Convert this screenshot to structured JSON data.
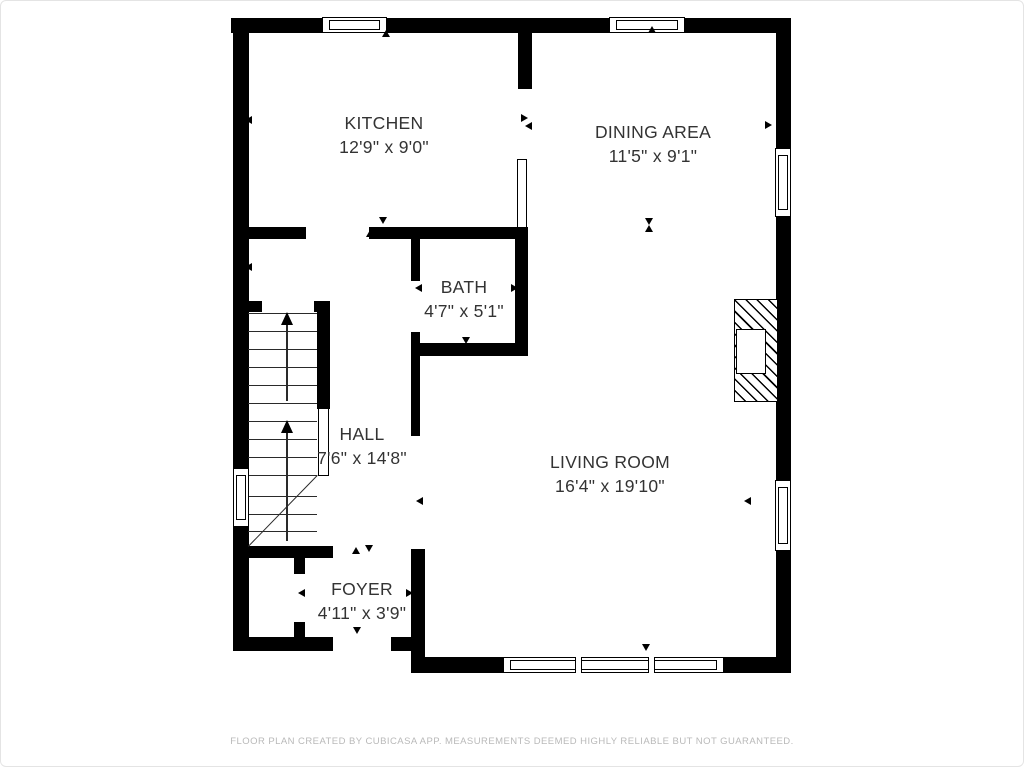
{
  "rooms": [
    {
      "name": "kitchen",
      "label": "KITCHEN",
      "dims": "12'9\" x 9'0\"",
      "cx": 383,
      "top": 110
    },
    {
      "name": "dining-area",
      "label": "DINING AREA",
      "dims": "11'5\" x 9'1\"",
      "cx": 652,
      "top": 119
    },
    {
      "name": "bath",
      "label": "BATH",
      "dims": "4'7\" x 5'1\"",
      "cx": 463,
      "top": 274
    },
    {
      "name": "hall",
      "label": "HALL",
      "dims": "7'6\" x 14'8\"",
      "cx": 361,
      "top": 421
    },
    {
      "name": "living-room",
      "label": "LIVING ROOM",
      "dims": "16'4\" x 19'10\"",
      "cx": 609,
      "top": 449
    },
    {
      "name": "foyer",
      "label": "FOYER",
      "dims": "4'11\" x 3'9\"",
      "cx": 361,
      "top": 576
    }
  ],
  "footer": {
    "text": "FLOOR PLAN CREATED BY CUBICASA APP. MEASUREMENTS DEEMED HIGHLY RELIABLE BUT NOT GUARANTEED."
  },
  "colors": {
    "wall": "#000000",
    "stair_line": "#2a2a2a",
    "room_text": "#333333",
    "footer_text": "#b9b9b9"
  },
  "plan_geometry": {
    "walls": [
      {
        "id": "exterior-top",
        "r": [
          230,
          17,
          560,
          15
        ]
      },
      {
        "id": "exterior-left",
        "r": [
          232,
          17,
          16,
          633
        ]
      },
      {
        "id": "foyer-bottom-left",
        "r": [
          232,
          636,
          100,
          14
        ]
      },
      {
        "id": "foyer-bottom-right",
        "r": [
          390,
          636,
          34,
          14
        ]
      },
      {
        "id": "living-left",
        "r": [
          410,
          548,
          14,
          124
        ]
      },
      {
        "id": "exterior-bottom",
        "r": [
          410,
          656,
          380,
          16
        ]
      },
      {
        "id": "exterior-right",
        "r": [
          775,
          17,
          15,
          655
        ]
      },
      {
        "id": "kitchen-dining-stub",
        "r": [
          517,
          30,
          14,
          58
        ]
      },
      {
        "id": "hall-top",
        "r": [
          245,
          226,
          60,
          12
        ]
      },
      {
        "id": "bath-top",
        "r": [
          368,
          226,
          159,
          12
        ]
      },
      {
        "id": "bath-left-upper",
        "r": [
          410,
          238,
          9,
          42
        ]
      },
      {
        "id": "bath-left-lower",
        "r": [
          410,
          331,
          9,
          23
        ]
      },
      {
        "id": "bath-bottom",
        "r": [
          410,
          342,
          117,
          13
        ]
      },
      {
        "id": "bath-right",
        "r": [
          514,
          226,
          13,
          129
        ]
      },
      {
        "id": "hall-right",
        "r": [
          410,
          354,
          9,
          81
        ]
      },
      {
        "id": "stair-stub-left",
        "r": [
          247,
          300,
          14,
          11
        ]
      },
      {
        "id": "stair-stub-right",
        "r": [
          313,
          300,
          15,
          11
        ]
      },
      {
        "id": "stair-right",
        "r": [
          316,
          300,
          13,
          108
        ]
      },
      {
        "id": "stair-bottom",
        "r": [
          247,
          545,
          85,
          12
        ]
      },
      {
        "id": "closet-right-upper",
        "r": [
          293,
          557,
          11,
          16
        ]
      },
      {
        "id": "closet-right-lower",
        "r": [
          293,
          621,
          11,
          16
        ]
      }
    ],
    "windows": [
      {
        "id": "kitchen-top",
        "orient": "h",
        "r": [
          321,
          16,
          65,
          16
        ]
      },
      {
        "id": "dining-top",
        "orient": "h",
        "r": [
          608,
          16,
          76,
          16
        ]
      },
      {
        "id": "dining-right",
        "orient": "v",
        "r": [
          774,
          147,
          16,
          69
        ]
      },
      {
        "id": "living-right",
        "orient": "v",
        "r": [
          774,
          479,
          16,
          71
        ]
      },
      {
        "id": "hall-left",
        "orient": "v",
        "r": [
          232,
          467,
          16,
          59
        ]
      },
      {
        "id": "living-bottom",
        "orient": "h",
        "r": [
          502,
          656,
          221,
          16
        ],
        "dividers": [
          71,
          144
        ]
      }
    ],
    "doors": [
      {
        "id": "kitchen-bath-leaf",
        "r": [
          516,
          158,
          10,
          69
        ]
      },
      {
        "id": "stair-leaf",
        "r": [
          317,
          407,
          11,
          68
        ]
      }
    ],
    "fireplace": {
      "outer": [
        733,
        298,
        44,
        103
      ],
      "firebox": [
        1,
        29,
        30,
        45
      ]
    },
    "stairs": {
      "treads": [
        {
          "y": 312,
          "x1": 247,
          "x2": 316
        },
        {
          "y": 330,
          "x1": 247,
          "x2": 316
        },
        {
          "y": 348,
          "x1": 247,
          "x2": 316
        },
        {
          "y": 366,
          "x1": 247,
          "x2": 316
        },
        {
          "y": 384,
          "x1": 247,
          "x2": 316
        },
        {
          "y": 402,
          "x1": 247,
          "x2": 316
        },
        {
          "y": 420,
          "x1": 247,
          "x2": 316
        },
        {
          "y": 438,
          "x1": 247,
          "x2": 316
        },
        {
          "y": 456,
          "x1": 247,
          "x2": 316
        },
        {
          "y": 474,
          "x1": 247,
          "x2": 316
        },
        {
          "y": 495,
          "x1": 247,
          "x2": 316
        },
        {
          "y": 513,
          "x1": 247,
          "x2": 316
        },
        {
          "y": 530,
          "x1": 247,
          "x2": 316
        }
      ],
      "diagonal": {
        "x1": 247,
        "y1": 545,
        "x2": 316,
        "y2": 474
      },
      "arrows": [
        {
          "x": 285,
          "head_y": 311,
          "stem_y1": 324,
          "stem_y2": 400
        },
        {
          "x": 285,
          "head_y": 419,
          "stem_y1": 432,
          "stem_y2": 540
        }
      ]
    },
    "markers": [
      {
        "x": 385,
        "y": 33,
        "dir": "up"
      },
      {
        "x": 651,
        "y": 29,
        "dir": "up"
      },
      {
        "x": 248,
        "y": 119,
        "dir": "left"
      },
      {
        "x": 524,
        "y": 117,
        "dir": "right"
      },
      {
        "x": 528,
        "y": 125,
        "dir": "left"
      },
      {
        "x": 648,
        "y": 221,
        "dir": "down"
      },
      {
        "x": 648,
        "y": 228,
        "dir": "up"
      },
      {
        "x": 382,
        "y": 220,
        "dir": "down"
      },
      {
        "x": 369,
        "y": 233,
        "dir": "up"
      },
      {
        "x": 464,
        "y": 232,
        "dir": "up"
      },
      {
        "x": 418,
        "y": 287,
        "dir": "left"
      },
      {
        "x": 514,
        "y": 287,
        "dir": "right"
      },
      {
        "x": 465,
        "y": 340,
        "dir": "down"
      },
      {
        "x": 248,
        "y": 266,
        "dir": "left"
      },
      {
        "x": 419,
        "y": 500,
        "dir": "left"
      },
      {
        "x": 355,
        "y": 550,
        "dir": "up"
      },
      {
        "x": 368,
        "y": 548,
        "dir": "down"
      },
      {
        "x": 301,
        "y": 592,
        "dir": "left"
      },
      {
        "x": 409,
        "y": 592,
        "dir": "right"
      },
      {
        "x": 356,
        "y": 630,
        "dir": "down"
      },
      {
        "x": 768,
        "y": 124,
        "dir": "right"
      },
      {
        "x": 747,
        "y": 500,
        "dir": "left"
      },
      {
        "x": 645,
        "y": 647,
        "dir": "down"
      }
    ]
  }
}
